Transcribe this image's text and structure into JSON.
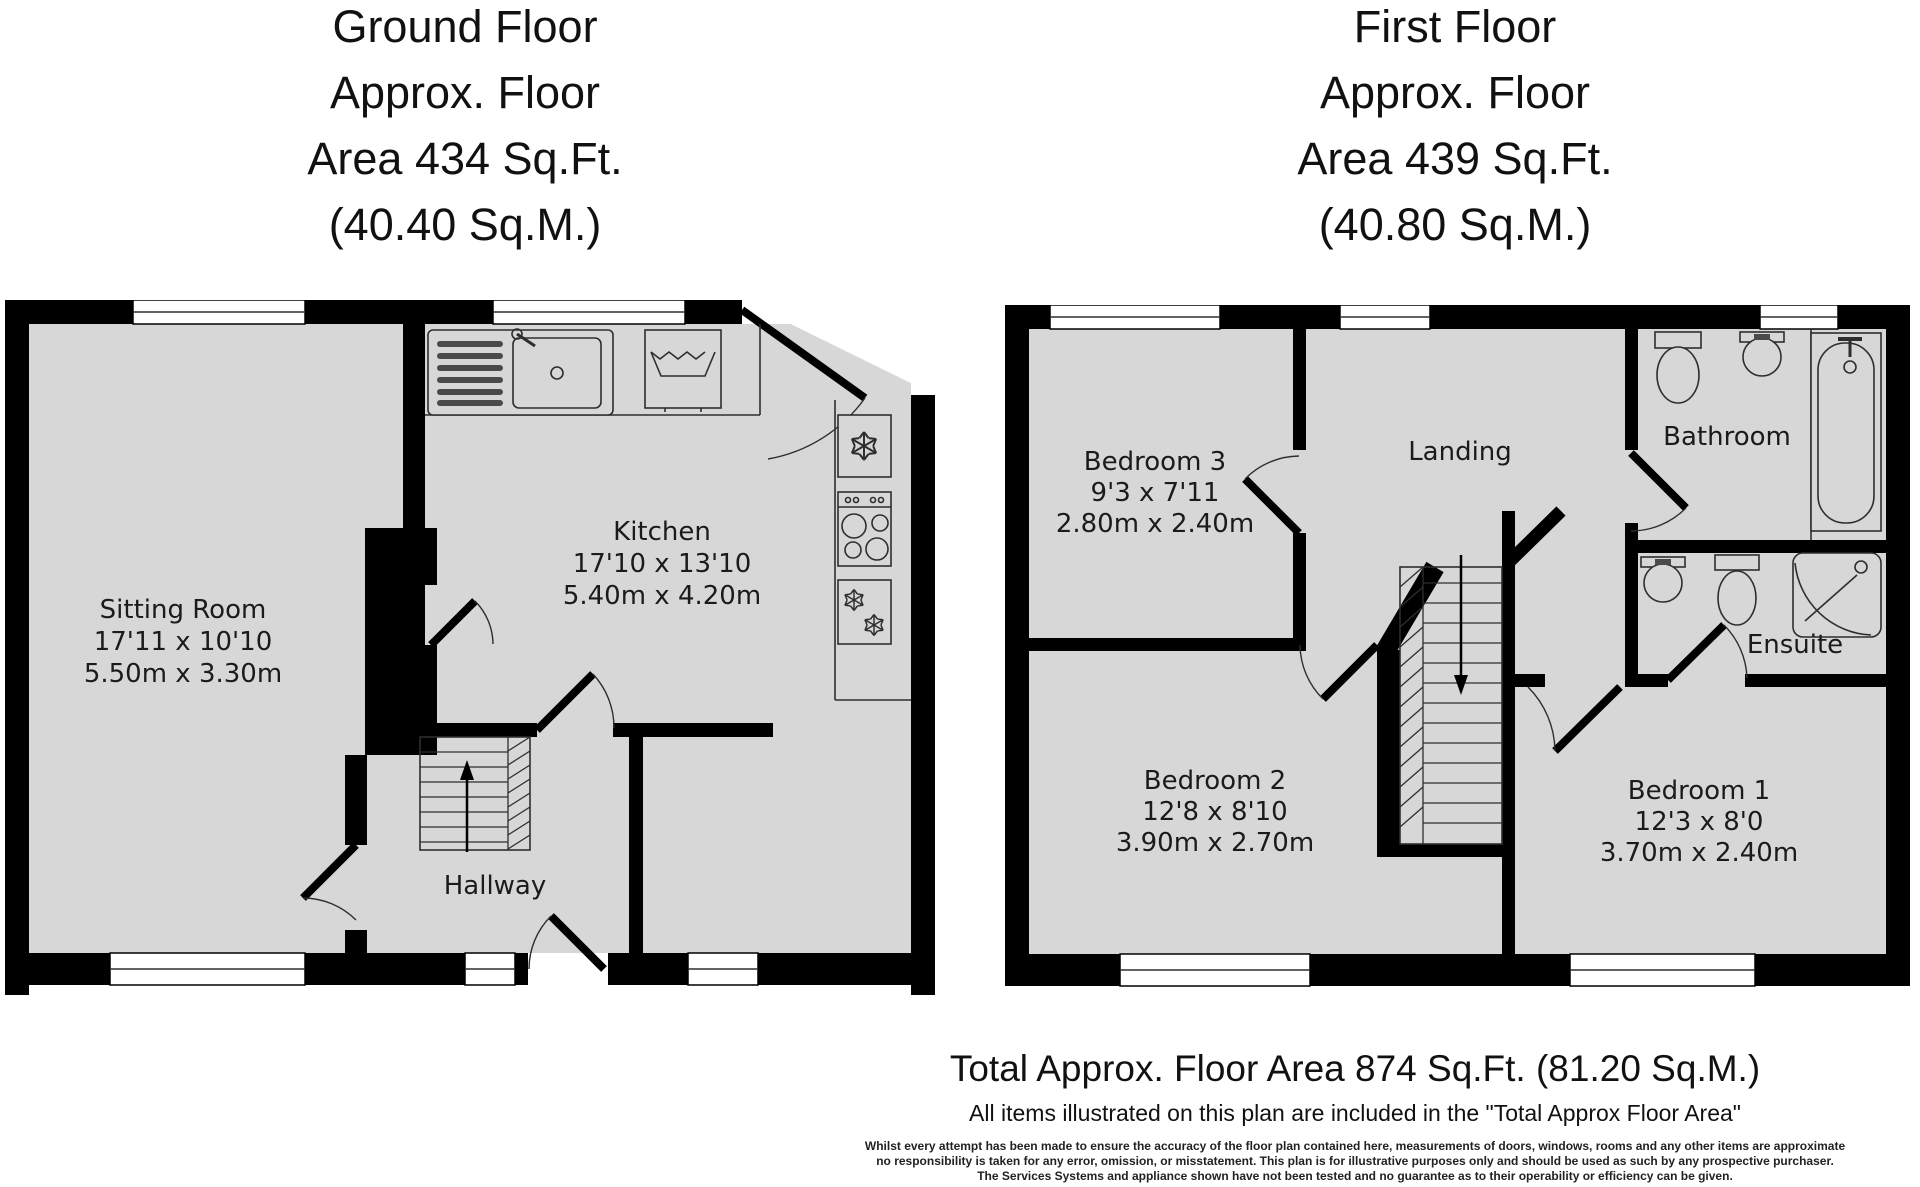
{
  "colors": {
    "wall": "#000000",
    "floor": "#d7d7d7",
    "background": "#ffffff"
  },
  "ground_floor": {
    "title_lines": [
      "Ground Floor",
      "Approx. Floor",
      "Area 434 Sq.Ft.",
      "(40.40 Sq.M.)"
    ],
    "rooms": {
      "sitting_room": {
        "name": "Sitting Room",
        "imperial": "17'11 x 10'10",
        "metric": "5.50m x 3.30m"
      },
      "kitchen": {
        "name": "Kitchen",
        "imperial": "17'10 x 13'10",
        "metric": "5.40m x 4.20m"
      },
      "hallway": {
        "name": "Hallway"
      }
    }
  },
  "first_floor": {
    "title_lines": [
      "First Floor",
      "Approx. Floor",
      "Area 439 Sq.Ft.",
      "(40.80 Sq.M.)"
    ],
    "rooms": {
      "bedroom3": {
        "name": "Bedroom 3",
        "imperial": "9'3 x 7'11",
        "metric": "2.80m x 2.40m"
      },
      "landing": {
        "name": "Landing"
      },
      "bathroom": {
        "name": "Bathroom"
      },
      "ensuite": {
        "name": "Ensuite"
      },
      "bedroom2": {
        "name": "Bedroom 2",
        "imperial": "12'8 x 8'10",
        "metric": "3.90m x 2.70m"
      },
      "bedroom1": {
        "name": "Bedroom 1",
        "imperial": "12'3 x 8'0",
        "metric": "3.70m x 2.40m"
      }
    }
  },
  "footer": {
    "total": "Total Approx. Floor Area 874 Sq.Ft. (81.20 Sq.M.)",
    "included": "All items illustrated on this plan are included in the \"Total Approx Floor Area\"",
    "disclaimer_lines": [
      "Whilst every attempt has been made to ensure the accuracy of the floor plan contained here, measurements of doors, windows, rooms and any other items are approximate",
      "no responsibility is taken for any error, omission, or misstatement. This plan is for illustrative purposes only and should be used as such by any prospective purchaser.",
      "The Services Systems and appliance shown have not been tested and no guarantee as to their operability or efficiency can be given."
    ]
  }
}
